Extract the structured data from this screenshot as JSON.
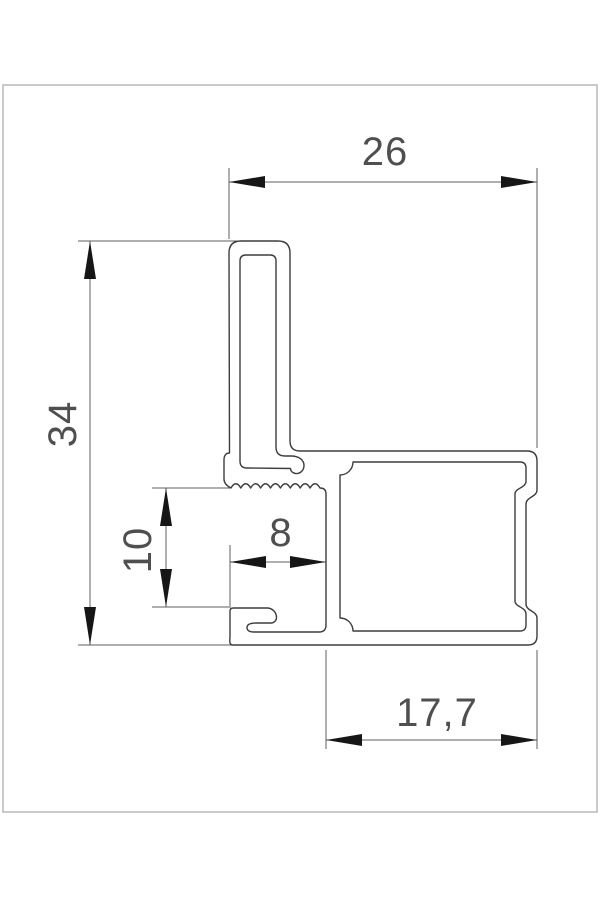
{
  "drawing": {
    "kind": "profile-cross-section-dimension-drawing",
    "dims": {
      "top_width": "26",
      "left_height": "34",
      "channel_height": "10",
      "channel_depth": "8",
      "bottom_width": "17,7"
    },
    "colors": {
      "outline": "#3d3d3d",
      "dimension_lines": "#5f5f5f",
      "arrowheads": "#161616",
      "text": "#4f4f4f",
      "frame": "#b9b9b9",
      "background": "#ffffff"
    }
  }
}
